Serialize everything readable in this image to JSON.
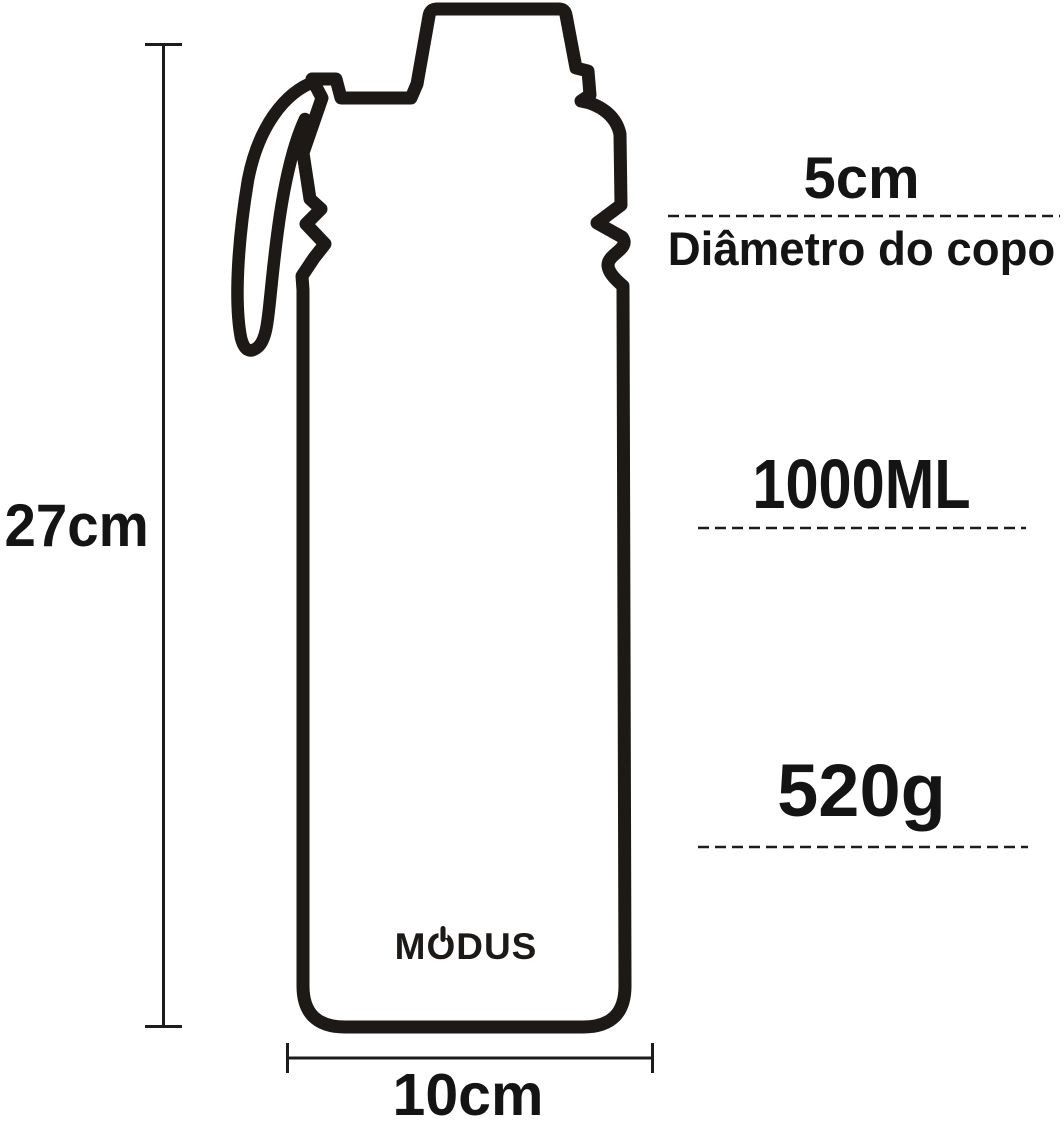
{
  "diagram": {
    "brand": "MODUS",
    "height_label": "27cm",
    "width_label": "10cm",
    "diameter": {
      "value": "5cm",
      "caption": "Diâmetro do copo"
    },
    "capacity_label": "1000ML",
    "weight_label": "520g",
    "colors": {
      "outline": "#1d1916",
      "text": "#141414",
      "background": "#ffffff"
    }
  }
}
